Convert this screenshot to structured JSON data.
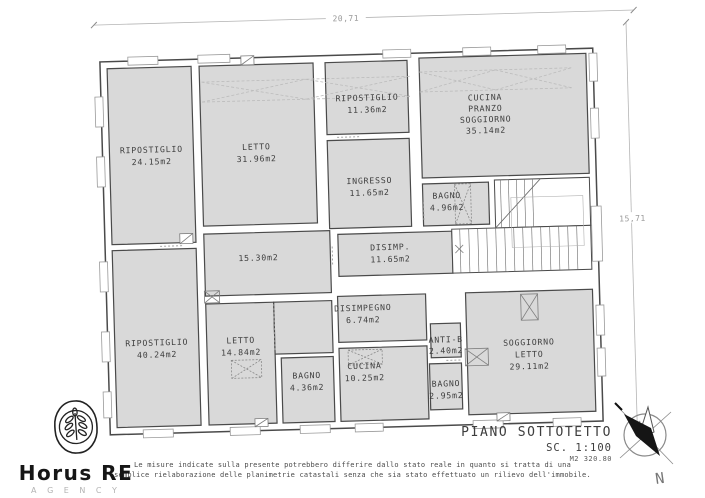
{
  "plan": {
    "title": "PIANO SOTTOTETTO",
    "scale": "SC. 1:100",
    "area_total": "M2 320.80",
    "dim_width": "20,71",
    "dim_height": "15,71",
    "compass": {
      "north_label": "N"
    },
    "rooms": [
      {
        "lines": [
          "RIPOSTIGLIO",
          "24.15m2"
        ]
      },
      {
        "lines": [
          "LETTO",
          "31.96m2"
        ]
      },
      {
        "lines": [
          "RIPOSTIGLIO",
          "11.36m2"
        ]
      },
      {
        "lines": [
          "CUCINA",
          "PRANZO",
          "SOGGIORNO",
          "35.14m2"
        ]
      },
      {
        "lines": [
          "INGRESSO",
          "11.65m2"
        ]
      },
      {
        "lines": [
          "BAGNO",
          "4.96m2"
        ]
      },
      {
        "lines": [
          "15.30m2"
        ]
      },
      {
        "lines": [
          "DISIMP.",
          "11.65m2"
        ]
      },
      {
        "lines": [
          "RIPOSTIGLIO",
          "40.24m2"
        ]
      },
      {
        "lines": [
          "LETTO",
          "14.84m2"
        ]
      },
      {
        "lines": [
          "BAGNO",
          "4.36m2"
        ]
      },
      {
        "lines": [
          "DISIMPEGNO",
          "6.74m2"
        ]
      },
      {
        "lines": [
          "CUCINA",
          "10.25m2"
        ]
      },
      {
        "lines": [
          "ANTI-B",
          "2.40m2"
        ]
      },
      {
        "lines": [
          "BAGNO",
          "2.95m2"
        ]
      },
      {
        "lines": [
          "SOGGIORNO",
          "LETTO",
          "29.11m2"
        ]
      }
    ],
    "disclaimer_line1": "Le misure indicate sulla presente potrebbero differire dallo stato reale in quanto si tratta di una",
    "disclaimer_line2": "semplice rielaborazione delle planimetrie catastali senza che sia stato effettuato un rilievo dell'immobile."
  },
  "logo": {
    "name": "Horus RE",
    "subtitle": "A G E N C Y"
  },
  "colors": {
    "room_fill": "#d9d9d9",
    "wall_stroke": "#4a4a4a",
    "dim_line": "#b5b5b5",
    "label_text": "#3d3d3d"
  }
}
